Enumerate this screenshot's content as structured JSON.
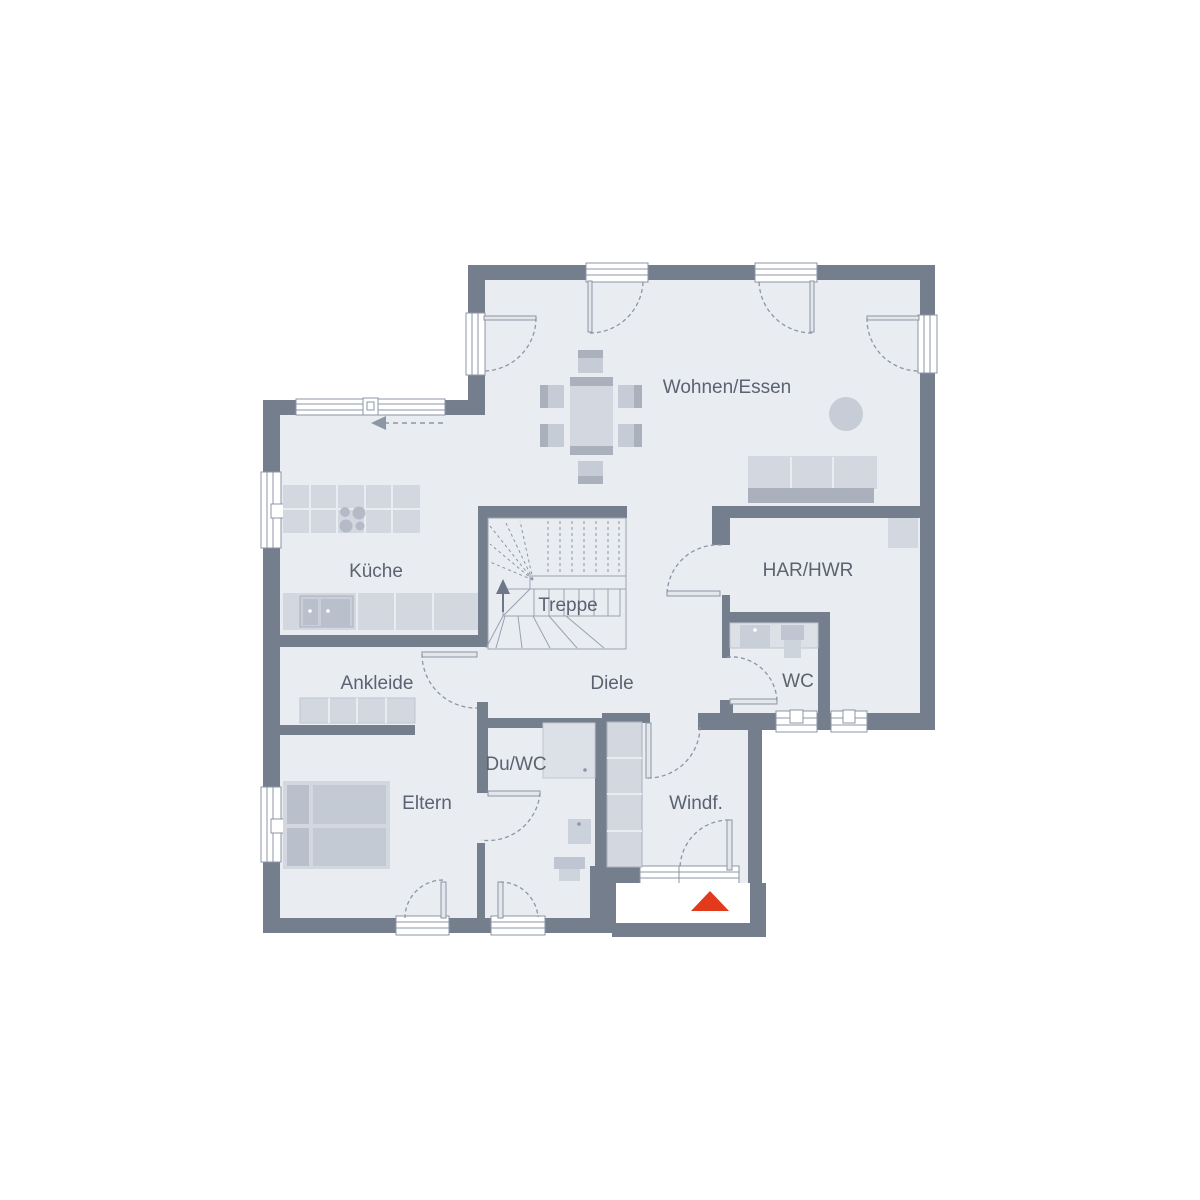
{
  "rooms": [
    {
      "name": "Wohnen/Essen"
    },
    {
      "name": "Küche"
    },
    {
      "name": "Treppe"
    },
    {
      "name": "HAR/HWR"
    },
    {
      "name": "WC"
    },
    {
      "name": "Ankleide"
    },
    {
      "name": "Diele"
    },
    {
      "name": "Du/WC"
    },
    {
      "name": "Eltern"
    },
    {
      "name": "Windf."
    }
  ],
  "symbols": {
    "entrance_marker": "red-triangle",
    "stair_direction": "up-arrow",
    "sliding_door": "dashed-arrow-left"
  },
  "colors": {
    "wall": "#757e8d",
    "floor": "#e9ecf1",
    "furniture_light": "#d3d8e0",
    "furniture_mid": "#c5ccd6",
    "furniture_dark": "#aab1bd",
    "outline": "#8d96a4",
    "label_text": "#5b6370",
    "entrance_marker": "#e23a1b"
  }
}
